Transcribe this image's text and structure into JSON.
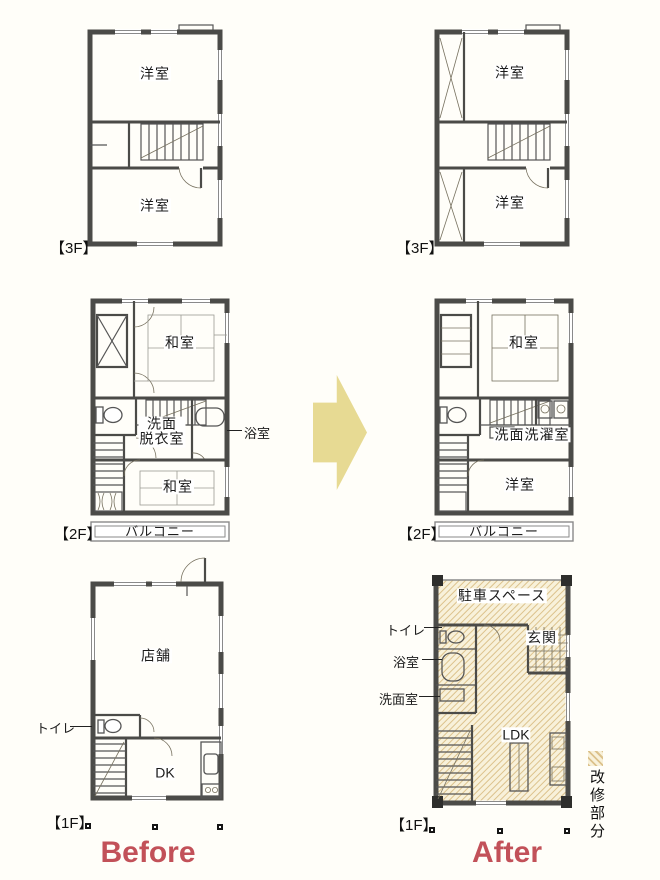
{
  "titles": {
    "before": "Before",
    "after": "After"
  },
  "legend": {
    "label": "改修部分"
  },
  "floor_labels": {
    "f3": "【3F】",
    "f2": "【2F】",
    "f1": "【1F】"
  },
  "before_3f": {
    "room_top": "洋室",
    "room_bottom": "洋室"
  },
  "before_2f": {
    "room_top": "和室",
    "washroom_l1": "洗面",
    "washroom_l2": "脱衣室",
    "bath": "浴室",
    "room_bottom": "和室",
    "balcony": "バルコニー"
  },
  "before_1f": {
    "shop": "店舗",
    "toilet": "トイレ",
    "dk": "DK"
  },
  "after_3f": {
    "room_top": "洋室",
    "room_bottom": "洋室"
  },
  "after_2f": {
    "room_top": "和室",
    "washroom": "洗面洗濯室",
    "room_bottom": "洋室",
    "balcony": "バルコニー"
  },
  "after_1f": {
    "parking": "駐車スペース",
    "entrance": "玄関",
    "toilet": "トイレ",
    "bath": "浴室",
    "washroom": "洗面室",
    "ldk": "LDK"
  },
  "colors": {
    "accent_red": "#c25159",
    "arrow": "#e7da93",
    "hatch_line": "#dcc28c",
    "hatch_bg": "#f8f1da",
    "wall": "#4b4b48"
  }
}
